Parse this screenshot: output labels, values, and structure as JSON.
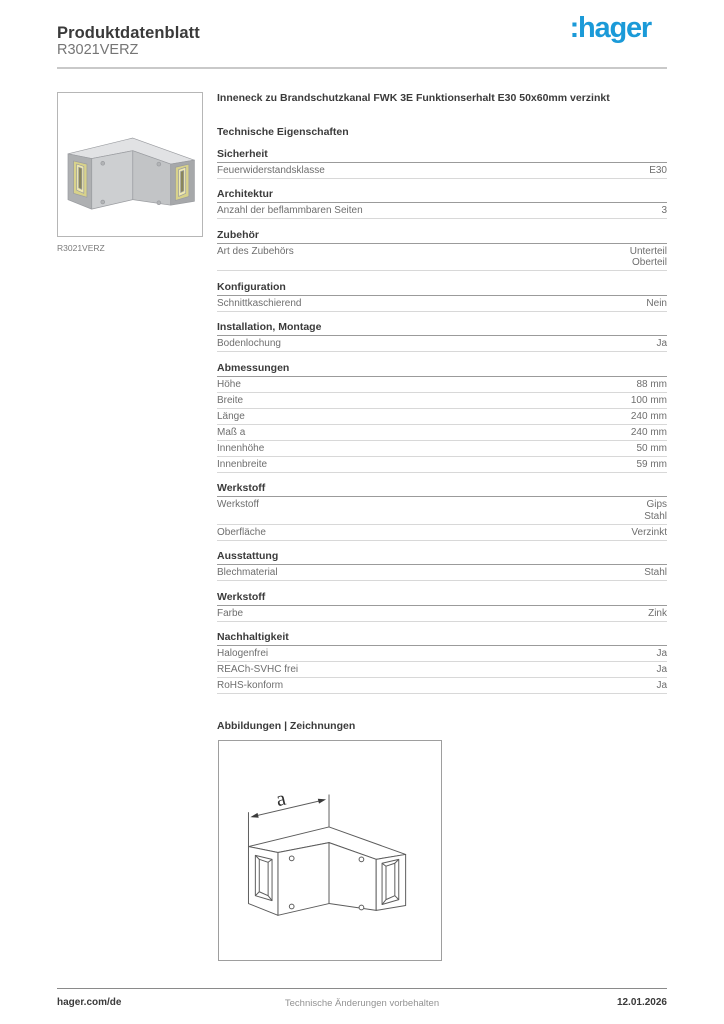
{
  "header": {
    "title": "Produktdatenblatt",
    "product_id": "R3021VERZ",
    "logo_text": ":hager"
  },
  "product": {
    "title": "Inneneck zu Brandschutzkanal FWK 3E Funktionserhalt E30 50x60mm verzinkt",
    "image_caption": "R3021VERZ"
  },
  "tech": {
    "heading": "Technische Eigenschaften",
    "sections": [
      {
        "title": "Sicherheit",
        "rows": [
          {
            "label": "Feuerwiderstandsklasse",
            "values": [
              "E30"
            ]
          }
        ]
      },
      {
        "title": "Architektur",
        "rows": [
          {
            "label": "Anzahl der beflammbaren Seiten",
            "values": [
              "3"
            ]
          }
        ]
      },
      {
        "title": "Zubehör",
        "rows": [
          {
            "label": "Art des Zubehörs",
            "values": [
              "Unterteil",
              "Oberteil"
            ]
          }
        ]
      },
      {
        "title": "Konfiguration",
        "rows": [
          {
            "label": "Schnittkaschierend",
            "values": [
              "Nein"
            ]
          }
        ]
      },
      {
        "title": "Installation, Montage",
        "rows": [
          {
            "label": "Bodenlochung",
            "values": [
              "Ja"
            ]
          }
        ]
      },
      {
        "title": "Abmessungen",
        "rows": [
          {
            "label": "Höhe",
            "values": [
              "88 mm"
            ]
          },
          {
            "label": "Breite",
            "values": [
              "100 mm"
            ]
          },
          {
            "label": "Länge",
            "values": [
              "240 mm"
            ]
          },
          {
            "label": "Maß a",
            "values": [
              "240 mm"
            ]
          },
          {
            "label": "Innenhöhe",
            "values": [
              "50 mm"
            ]
          },
          {
            "label": "Innenbreite",
            "values": [
              "59 mm"
            ]
          }
        ]
      },
      {
        "title": "Werkstoff",
        "rows": [
          {
            "label": "Werkstoff",
            "values": [
              "Gips",
              "Stahl"
            ]
          },
          {
            "label": "Oberfläche",
            "values": [
              "Verzinkt"
            ]
          }
        ]
      },
      {
        "title": "Ausstattung",
        "rows": [
          {
            "label": "Blechmaterial",
            "values": [
              "Stahl"
            ]
          }
        ]
      },
      {
        "title": "Werkstoff",
        "rows": [
          {
            "label": "Farbe",
            "values": [
              "Zink"
            ]
          }
        ]
      },
      {
        "title": "Nachhaltigkeit",
        "rows": [
          {
            "label": "Halogenfrei",
            "values": [
              "Ja"
            ]
          },
          {
            "label": "REACh-SVHC frei",
            "values": [
              "Ja"
            ]
          },
          {
            "label": "RoHS-konform",
            "values": [
              "Ja"
            ]
          }
        ]
      }
    ]
  },
  "drawings": {
    "heading": "Abbildungen | Zeichnungen",
    "dimension_label": "a"
  },
  "footer": {
    "left": "hager.com/de",
    "center": "Technische Änderungen vorbehalten",
    "right": "12.01.2026"
  },
  "colors": {
    "brand_blue": "#1b9ad8",
    "heading_text": "#3a3a3a",
    "row_text": "#6e6e6e",
    "rule_gray": "#c9c9c9"
  }
}
